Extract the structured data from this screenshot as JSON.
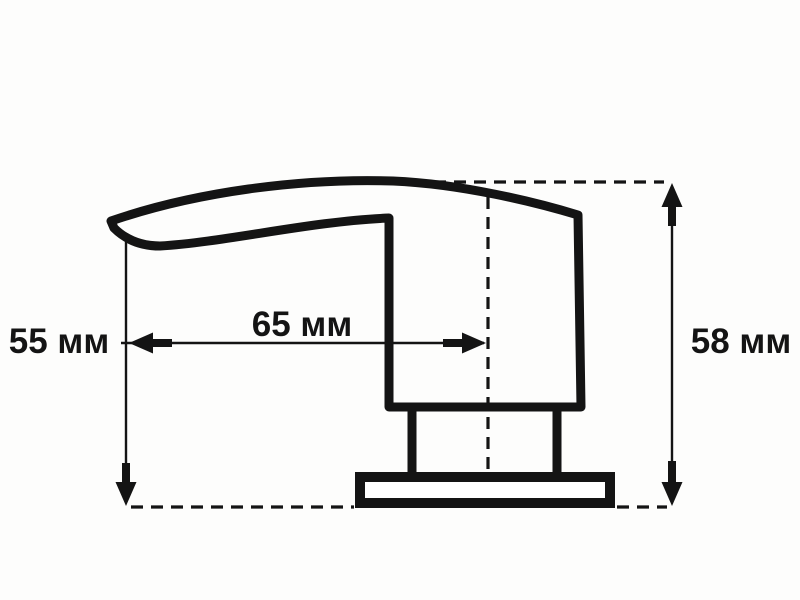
{
  "colors": {
    "background": "#fdfdfc",
    "line": "#141414",
    "text": "#141414"
  },
  "dimensions": {
    "left_height_label": "55 мм",
    "reach_label": "65 мм",
    "right_height_label": "58 мм"
  }
}
